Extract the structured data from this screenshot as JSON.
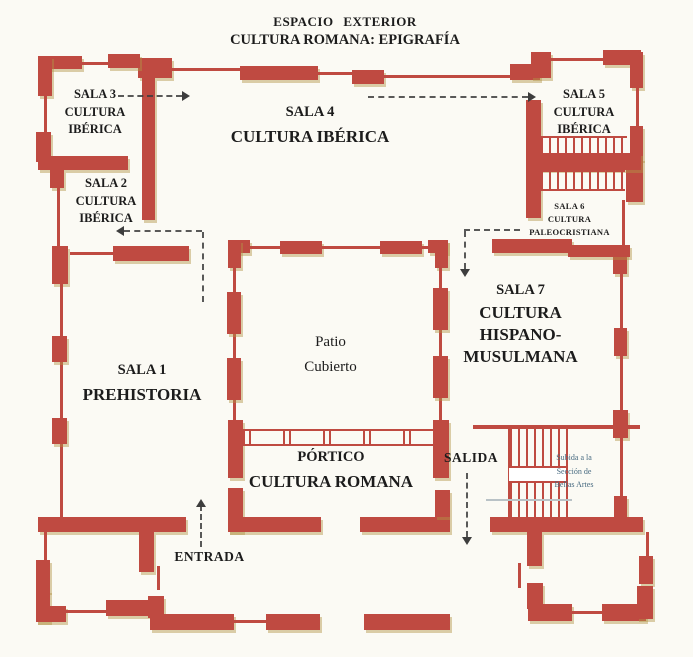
{
  "title_block": {
    "line1": "ESPACIO EXTERIOR",
    "line2": "CULTURA ROMANA: EPIGRAFÍA"
  },
  "rooms": {
    "sala3": {
      "lines": [
        "SALA 3",
        "CULTURA",
        "IBÉRICA"
      ]
    },
    "sala2": {
      "lines": [
        "SALA 2",
        "CULTURA",
        "IBÉRICA"
      ]
    },
    "sala4": {
      "name": "SALA 4",
      "subtitle": "CULTURA IBÉRICA"
    },
    "sala5": {
      "lines": [
        "SALA 5",
        "CULTURA",
        "IBÉRICA"
      ]
    },
    "sala6": {
      "lines": [
        "SALA 6",
        "CULTURA",
        "PALEOCRISTIANA"
      ]
    },
    "sala7": {
      "name": "SALA 7",
      "subtitle_lines": [
        "CULTURA",
        "HISPANO-",
        "MUSULMANA"
      ]
    },
    "sala1": {
      "name": "SALA 1",
      "subtitle": "PREHISTORIA"
    },
    "patio": {
      "lines": [
        "Patio",
        "Cubierto"
      ]
    },
    "portico": {
      "name": "PÓRTICO",
      "subtitle": "CULTURA ROMANA"
    }
  },
  "labels": {
    "entrada": "ENTRADA",
    "salida": "SALIDA",
    "stairs_note_lines": [
      "Subida a la",
      "Sección de",
      "Bellas Artes"
    ]
  },
  "colors": {
    "wall": "#bf4a41",
    "wall_shadow": "#c2a464",
    "text": "#1c1c1c",
    "note": "#476a80",
    "arrow": "#3d3d3d",
    "background": "#fbfaf4"
  }
}
